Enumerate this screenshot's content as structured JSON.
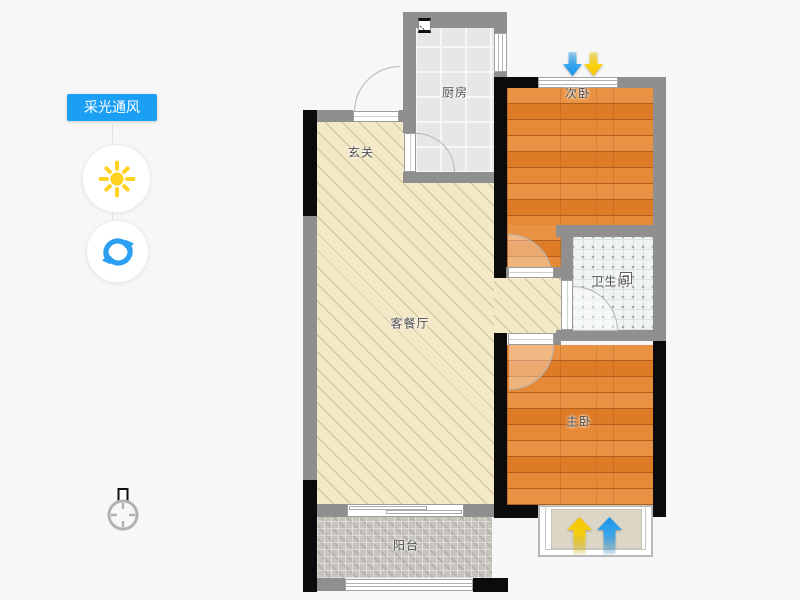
{
  "app": {
    "background": "#f7f7f7"
  },
  "sidebar": {
    "tool_button": {
      "label": "采光通风",
      "bg": "#1b9ff5"
    },
    "sun_button": {
      "icon": "sun-icon",
      "color": "#ffd21e"
    },
    "refresh_button": {
      "icon": "refresh-icon",
      "color": "#2b9ff2"
    }
  },
  "compass": {
    "icon": "compass-icon"
  },
  "floorplan": {
    "rooms": {
      "kitchen": {
        "label": "厨房"
      },
      "bedroom2": {
        "label": "次卧"
      },
      "hallway": {
        "label": "玄关"
      },
      "living": {
        "label": "客餐厅"
      },
      "bathroom": {
        "label": "卫生间"
      },
      "bedroom1": {
        "label": "主卧"
      },
      "balcony": {
        "label": "阳台"
      }
    },
    "indicators": {
      "top": [
        "ventilation-arrow-blue-down",
        "light-arrow-yellow-down"
      ],
      "bottom": [
        "light-arrow-yellow-up",
        "ventilation-arrow-blue-up"
      ]
    },
    "colors": {
      "wall": "#8f8f8f",
      "load_bearing_wall": "#0b0b0b",
      "wood_floor": "#df7f2d",
      "living_floor": "#f3e9c7",
      "arrow_blue": "#2aa4f4",
      "arrow_yellow": "#ffd400"
    }
  }
}
